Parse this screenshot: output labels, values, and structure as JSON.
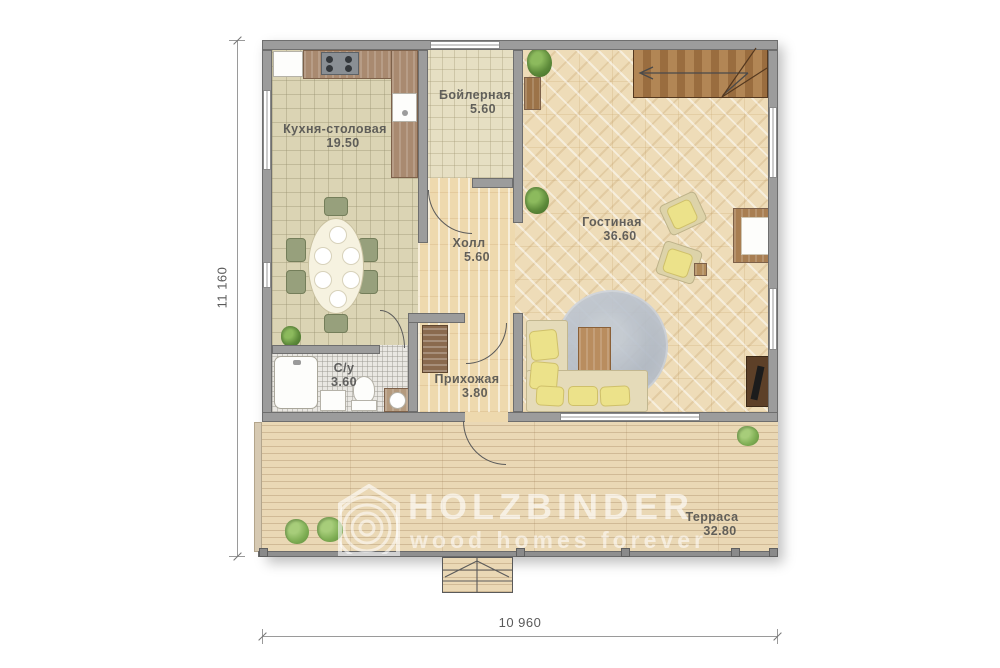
{
  "plan_title": "first-floor-plan",
  "rooms": [
    {
      "name": "Кухня-столовая",
      "area": "19.50"
    },
    {
      "name": "Бойлерная",
      "area": "5.60"
    },
    {
      "name": "Гостиная",
      "area": "36.60"
    },
    {
      "name": "Холл",
      "area": "5.60"
    },
    {
      "name": "Прихожая",
      "area": "3.80"
    },
    {
      "name": "С/у",
      "area": "3.60"
    },
    {
      "name": "Терраса",
      "area": "32.80"
    }
  ],
  "dimensions": {
    "vertical": "11 160",
    "horizontal": "10 960"
  },
  "watermark": {
    "title": "HOLZBINDER",
    "subtitle": "wood homes forever"
  },
  "palette": {
    "wall_fill": "#9c9c9c",
    "wall_border": "#6e6e6e",
    "wood_floor": "#eed9ae",
    "tile_floor": "#dbd4b4",
    "parquet_floor": "#eedcb8",
    "terrace_floor": "#ead8b5",
    "stairs_wood": "#a3794a",
    "rug": "#aeb7c4",
    "sofa_cushion": "#ece28a",
    "plant_green": "#5d8a3a",
    "label_text": "#4a4a4a",
    "watermark_white": "rgba(255,255,255,0.6)"
  }
}
